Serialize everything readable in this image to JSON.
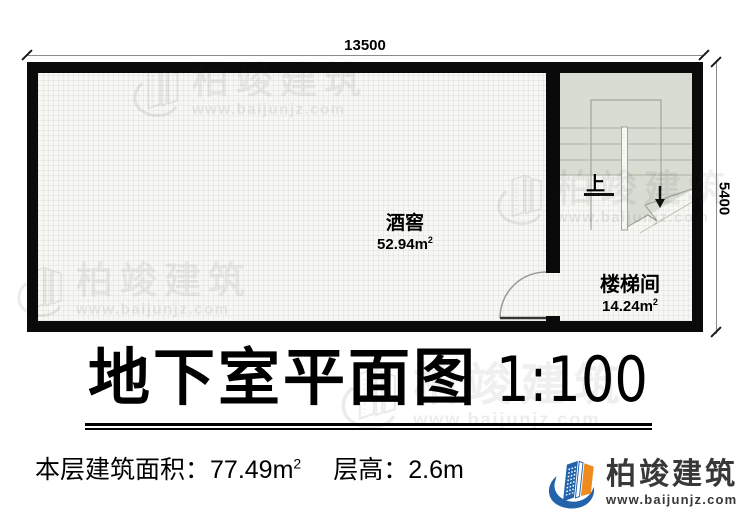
{
  "dimensions": {
    "top": "13500",
    "right": "5400"
  },
  "rooms": {
    "wine_cellar": {
      "name": "酒窖",
      "area": "52.94m",
      "area_sup": "2"
    },
    "stairwell": {
      "name": "楼梯间",
      "area": "14.24m",
      "area_sup": "2"
    }
  },
  "stair": {
    "up_label": "上"
  },
  "title": {
    "text": "地下室平面图",
    "scale": "1:100"
  },
  "info": {
    "area_label": "本层建筑面积：",
    "area_value": "77.49m",
    "area_sup": "2",
    "height_label": "层高：",
    "height_value": "2.6m"
  },
  "brand": {
    "name": "柏竣建筑",
    "url": "www.baijunjz.com"
  },
  "watermark": {
    "name": "柏竣建筑",
    "url": "www.baijunjz.com"
  },
  "colors": {
    "wall": "#0a0a0a",
    "floor": "#f7f7f4",
    "stair_tint": "#d8ddd3",
    "brand_blue": "#2263ac",
    "brand_orange": "#ef8a1f"
  }
}
